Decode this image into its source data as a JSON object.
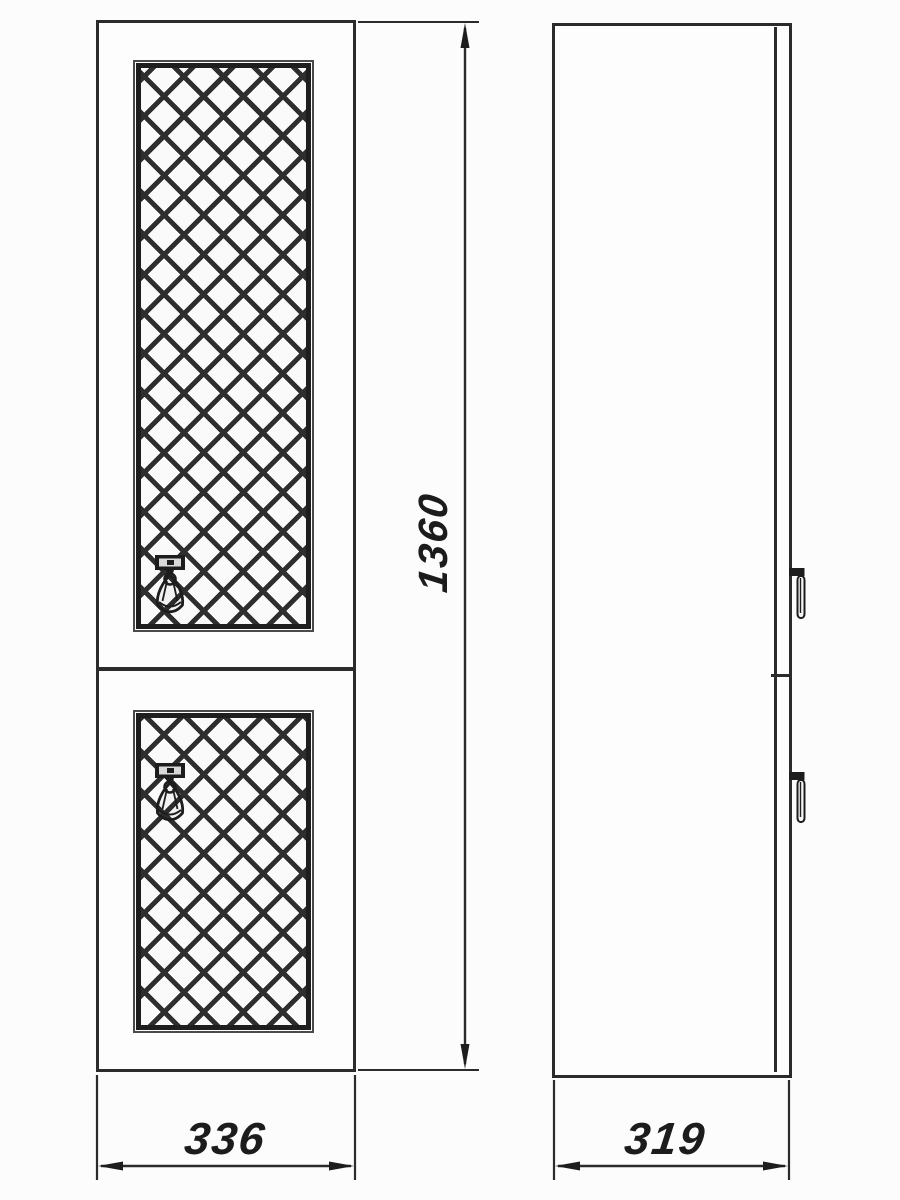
{
  "page": {
    "background_color": "#fcfcfc",
    "line_color": "#2b2b2b"
  },
  "drawing": {
    "type": "cabinet-technical-drawing",
    "views": {
      "front": "front-view-two-lattice-doors",
      "side": "side-view-with-drop-handles"
    },
    "dimension_labels": {
      "height": "1360",
      "front_width": "336",
      "side_depth": "319"
    },
    "icons": {
      "front_handle": "drop-tassel-handle-icon",
      "side_handle": "drop-handle-side-icon"
    }
  }
}
